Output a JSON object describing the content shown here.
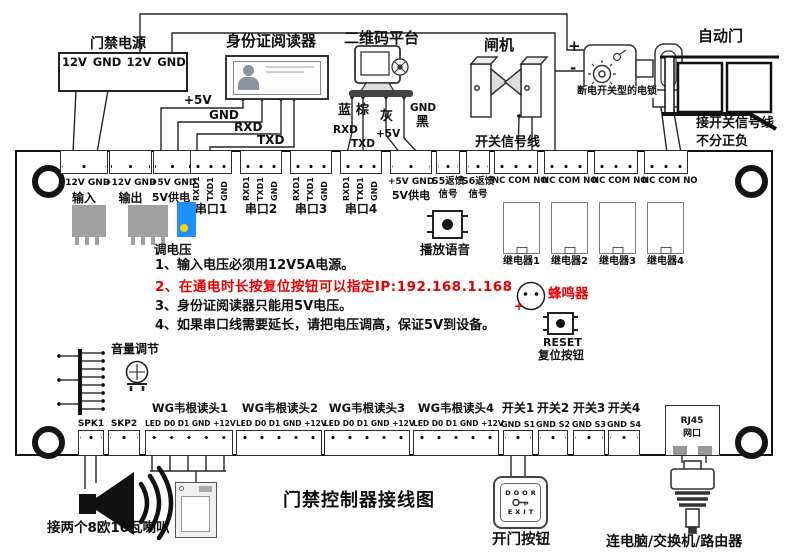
{
  "title": "门禁控制器接线图",
  "colors": {
    "wire": "#262626",
    "note_red": "#e60000",
    "pot_blue": "#1e90ff",
    "pot_dot": "#ffd400",
    "component_gray": "#a0a0a0"
  },
  "top_devices": {
    "power": {
      "title": "门禁电源",
      "terminals": [
        "12V",
        "GND",
        "12V",
        "GND"
      ]
    },
    "id_reader": {
      "title": "身份证阅读器",
      "wire_labels": [
        "+5V",
        "GND",
        "RXD",
        "TXD"
      ]
    },
    "qr_platform": {
      "title": "二维码平台",
      "labels": {
        "blue": "蓝",
        "brown": "棕",
        "gray": "灰",
        "black": "黑",
        "rxd": "RXD",
        "txd": "TXD",
        "v5": "+5V",
        "gnd": "GND"
      }
    },
    "gate": {
      "title": "闸机",
      "wire_note": "开关信号线"
    },
    "lock": {
      "plus": "+",
      "minus": "-",
      "label": "断电开关型的电锁"
    },
    "auto_door": {
      "title": "自动门",
      "note1": "接开关信号线",
      "note2": "不分正负"
    }
  },
  "board": {
    "top_row": {
      "power_blocks": [
        {
          "pins": "+12V GND",
          "label": "输入"
        },
        {
          "pins": "+12V GND",
          "label": "输出"
        },
        {
          "pins": "+5V GND",
          "label": "5V供电"
        }
      ],
      "serial_ports": [
        {
          "pins": [
            "RXD1",
            "TXD1",
            "GND"
          ],
          "label": "串口1"
        },
        {
          "pins": [
            "RXD1",
            "TXD1",
            "GND"
          ],
          "label": "串口2"
        },
        {
          "pins": [
            "RXD1",
            "TXD1",
            "GND"
          ],
          "label": "串口3"
        },
        {
          "pins": [
            "RXD1",
            "TXD1",
            "GND"
          ],
          "label": "串口4"
        }
      ],
      "power5v": {
        "pins": "+5V GND",
        "label": "5V供电"
      },
      "signals": [
        {
          "line1": "S5返馈",
          "line2": "信号"
        },
        {
          "line1": "S6返馈",
          "line2": "信号"
        }
      ],
      "relays": [
        {
          "pins": "NC COM NO",
          "label": "继电器1"
        },
        {
          "pins": "NC COM NO",
          "label": "继电器2"
        },
        {
          "pins": "NC COM NO",
          "label": "继电器3"
        },
        {
          "pins": "NC COM NO",
          "label": "继电器4"
        }
      ]
    },
    "components": {
      "voltage_adjust": "调电压",
      "voice_play": "播放语音",
      "buzzer": {
        "label": "蜂鸣器",
        "plus": "+"
      },
      "reset": {
        "line1": "RESET",
        "line2": "复位按钮"
      },
      "volume": "音量调节"
    },
    "notes": [
      "1、输入电压必须用12V5A电源。",
      "2、在通电时长按复位按钮可以指定IP:192.168.1.168",
      "3、身份证阅读器只能用5V电压。",
      "4、如果串口线需要延长，请把电压调高，保证5V到设备。"
    ],
    "bottom_row": {
      "spk1": "SPK1",
      "skp2": "SKP2",
      "wiegand": [
        {
          "label": "WG韦根读头1",
          "pins": "LED D0 D1 GND +12V"
        },
        {
          "label": "WG韦根读头2",
          "pins": "LED D0 D1 GND +12V"
        },
        {
          "label": "WG韦根读头3",
          "pins": "LED D0 D1 GND +12V"
        },
        {
          "label": "WG韦根读头4",
          "pins": "LED D0 D1 GND +12V"
        }
      ],
      "switches": [
        {
          "label": "开关1",
          "pins": "GND S1"
        },
        {
          "label": "开关2",
          "pins": "GND S2"
        },
        {
          "label": "开关3",
          "pins": "GND S3"
        },
        {
          "label": "开关4",
          "pins": "GND S4"
        }
      ],
      "rj45": {
        "line1": "RJ45",
        "line2": "网口"
      }
    }
  },
  "bottom_devices": {
    "speaker_label": "接两个8欧10瓦喇叭",
    "exit_button": {
      "word1": "DOOR",
      "word2": "EXIT",
      "label": "开门按钮"
    },
    "network_label": "连电脑/交换机/路由器"
  }
}
